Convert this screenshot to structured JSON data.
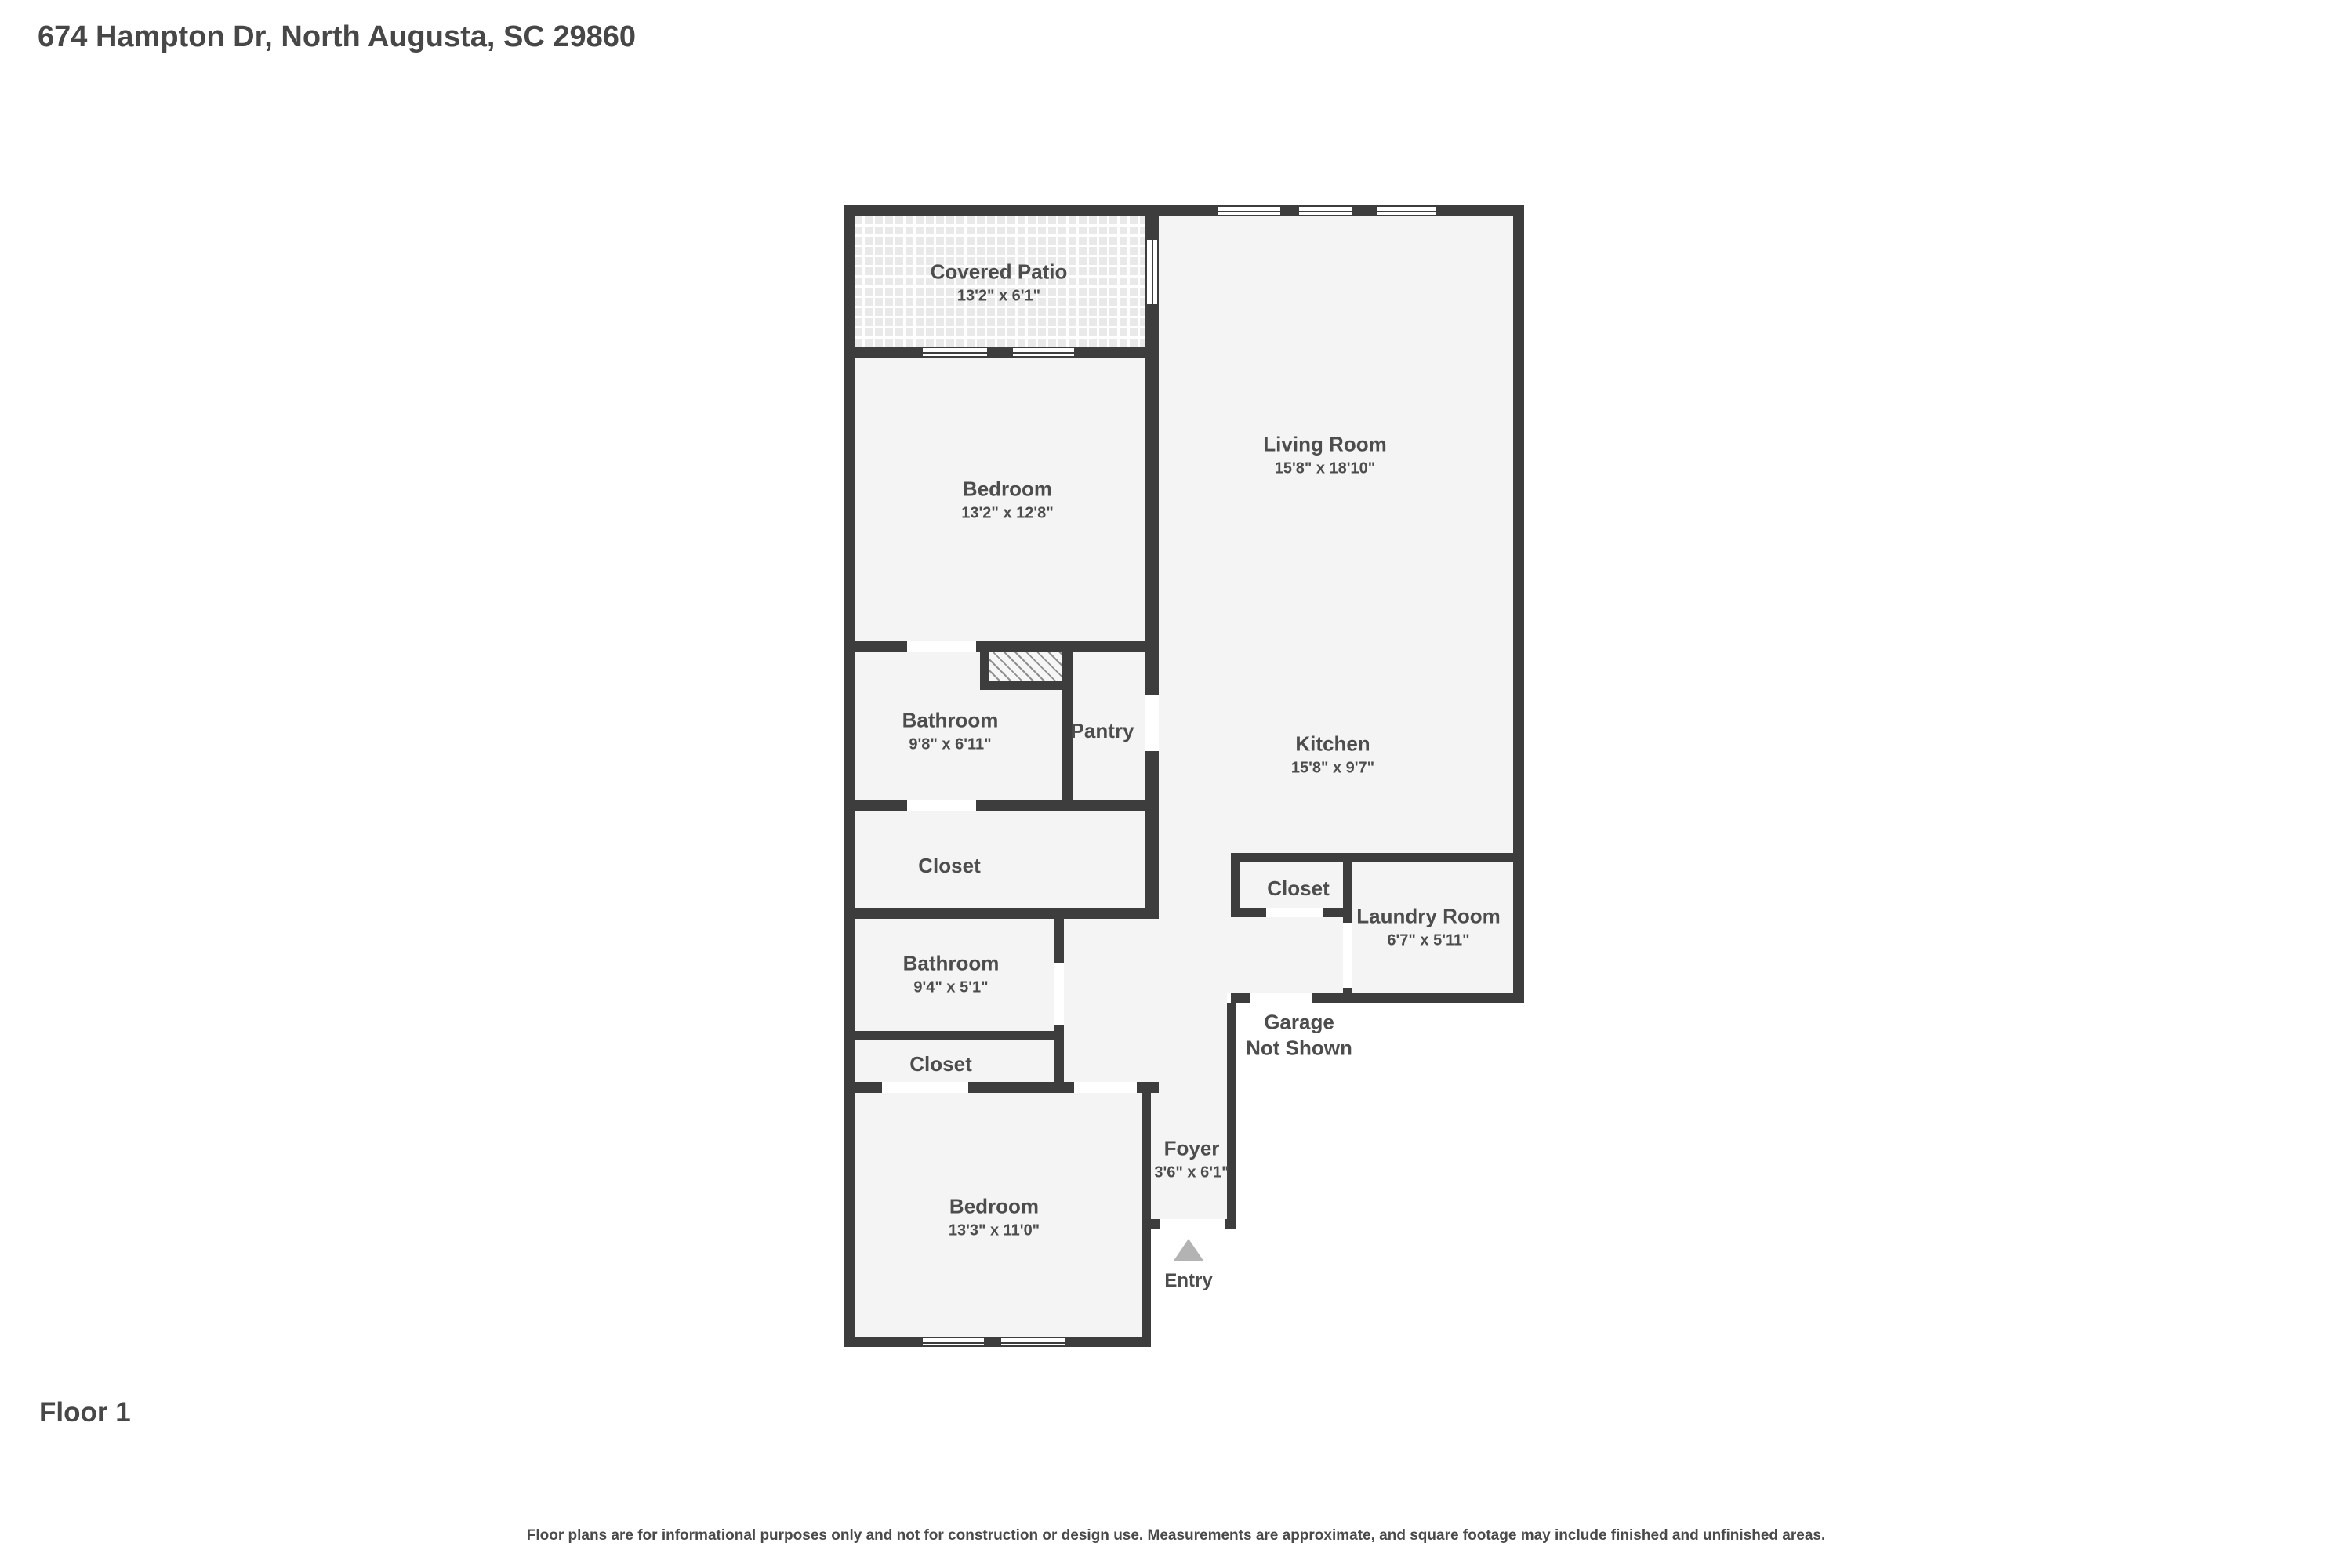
{
  "header": {
    "title": "674 Hampton Dr, North Augusta, SC 29860"
  },
  "floor_label": "Floor 1",
  "disclaimer": "Floor plans are for informational purposes only and not for construction or design use. Measurements are approximate, and square footage may include finished and unfinished areas.",
  "colors": {
    "wall": "#3d3d3d",
    "floor": "#f4f4f4",
    "text": "#4d4d4d",
    "entry_arrow": "#b3b3b3"
  },
  "rooms": {
    "covered_patio": {
      "name": "Covered Patio",
      "dims": "13'2\" x 6'1\""
    },
    "living_room": {
      "name": "Living Room",
      "dims": "15'8\" x 18'10\""
    },
    "bedroom_upper": {
      "name": "Bedroom",
      "dims": "13'2\" x 12'8\""
    },
    "bathroom_upper": {
      "name": "Bathroom",
      "dims": "9'8\" x 6'11\""
    },
    "pantry": {
      "name": "Pantry"
    },
    "kitchen": {
      "name": "Kitchen",
      "dims": "15'8\" x 9'7\""
    },
    "closet_hall": {
      "name": "Closet"
    },
    "closet_laundry": {
      "name": "Closet"
    },
    "laundry_room": {
      "name": "Laundry Room",
      "dims": "6'7\" x 5'11\""
    },
    "bathroom_lower": {
      "name": "Bathroom",
      "dims": "9'4\" x 5'1\""
    },
    "closet_lower": {
      "name": "Closet"
    },
    "garage": {
      "line1": "Garage",
      "line2": "Not Shown"
    },
    "foyer": {
      "name": "Foyer",
      "dims": "3'6\" x 6'1\""
    },
    "bedroom_lower": {
      "name": "Bedroom",
      "dims": "13'3\" x 11'0\""
    },
    "entry": {
      "name": "Entry"
    }
  }
}
